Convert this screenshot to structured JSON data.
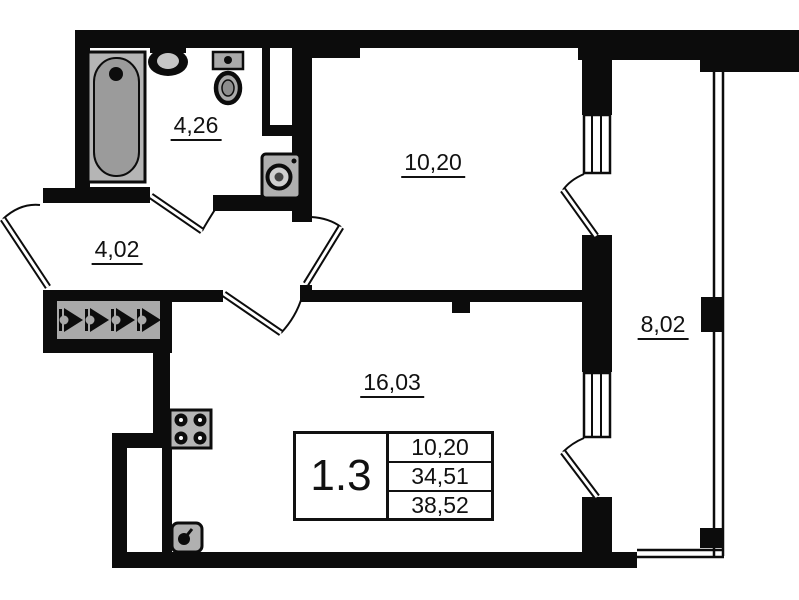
{
  "page": {
    "background": "#ffffff",
    "wall_color": "#0c0c0c",
    "fixture_fill": "#b5b5b5"
  },
  "plan": {
    "rooms": [
      {
        "name": "bathroom",
        "area": "4,26"
      },
      {
        "name": "hallway",
        "area": "4,02"
      },
      {
        "name": "bedroom",
        "area": "10,20"
      },
      {
        "name": "living-room",
        "area": "16,03"
      },
      {
        "name": "balcony",
        "area": "8,02"
      }
    ],
    "unit_label": {
      "id": "1.3",
      "rows": [
        "10,20",
        "34,51",
        "38,52"
      ]
    },
    "fixtures": [
      "bathtub",
      "bath-sink",
      "toilet",
      "washing-machine",
      "wardrobe-hooks",
      "stove",
      "kitchen-sink",
      "window",
      "door-arc",
      "balcony-glazing"
    ]
  }
}
